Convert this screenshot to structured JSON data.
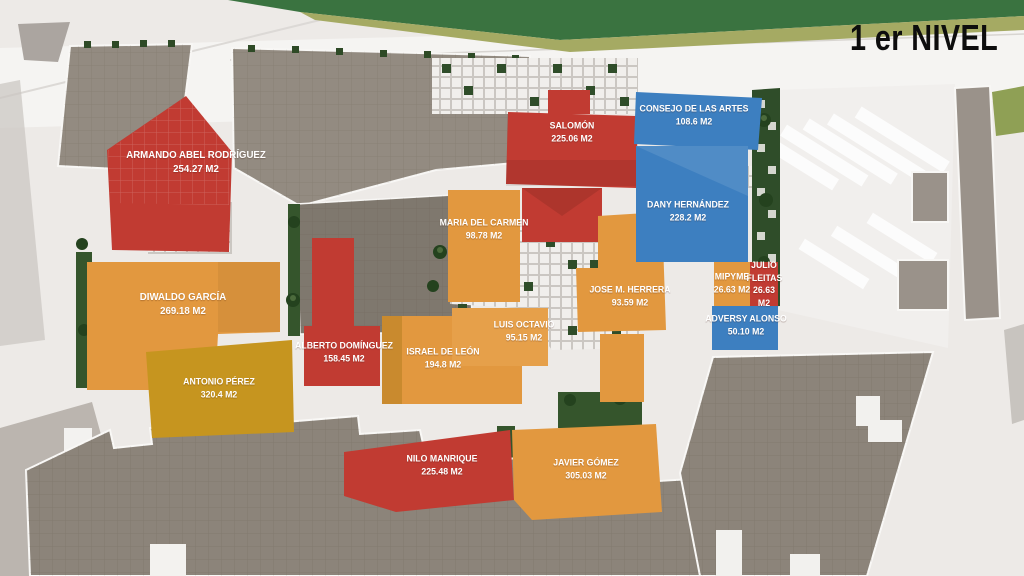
{
  "title": "1 er NIVEL",
  "colors": {
    "red": "#C13B32",
    "orange": "#E2983F",
    "gold": "#C6951F",
    "blue": "#3D7FC0",
    "context_roof": "#938B81",
    "context_roof_dark": "#7F786E",
    "context_mass": "#8C847A",
    "planting_green": "#2F4D29",
    "band_green": "#3A7340",
    "band_olive": "#A5AA63"
  },
  "units": [
    {
      "id": "armando",
      "name": "ARMANDO ABEL RODRÍGUEZ",
      "area": "254.27 m2",
      "color": "red"
    },
    {
      "id": "salomon",
      "name": "SALOMÓN",
      "area": "225.06 m2",
      "color": "red"
    },
    {
      "id": "consejo",
      "name": "CONSEJO DE LAS ARTES",
      "area": "108.6 m2",
      "color": "blue"
    },
    {
      "id": "maria",
      "name": "MARIA DEL CARMEN",
      "area": "98.78 m2",
      "color": "orange"
    },
    {
      "id": "dany",
      "name": "DANY HERNÁNDEZ",
      "area": "228.2 m2",
      "color": "blue"
    },
    {
      "id": "herrera",
      "name": "JOSE M. HERRERA",
      "area": "93.59 m2",
      "color": "orange"
    },
    {
      "id": "mipyme",
      "name": "MIPYME",
      "area": "26.63 m2",
      "color": "orange"
    },
    {
      "id": "julio",
      "name": "JULIO FLEITAS",
      "area": "26.63 m2",
      "color": "red"
    },
    {
      "id": "adversy",
      "name": "ADVERSY ALONSO",
      "area": "50.10 m2",
      "color": "blue"
    },
    {
      "id": "diwaldo",
      "name": "DIWALDO GARCÍA",
      "area": "269.18 m2",
      "color": "orange"
    },
    {
      "id": "alberto",
      "name": "ALBERTO DOMÍNGUEZ",
      "area": "158.45 m2",
      "color": "red"
    },
    {
      "id": "israel",
      "name": "ISRAEL DE LEÓN",
      "area": "194.8 m2",
      "color": "orange"
    },
    {
      "id": "luis",
      "name": "LUIS OCTAVIO",
      "area": "95.15 m2",
      "color": "orange"
    },
    {
      "id": "antonio",
      "name": "ANTONIO PÉREZ",
      "area": "320.4 m2",
      "color": "gold"
    },
    {
      "id": "nilo",
      "name": "NILO MANRIQUE",
      "area": "225.48 m2",
      "color": "red"
    },
    {
      "id": "javier",
      "name": "JAVIER GÓMEZ",
      "area": "305.03 m2",
      "color": "orange"
    }
  ]
}
